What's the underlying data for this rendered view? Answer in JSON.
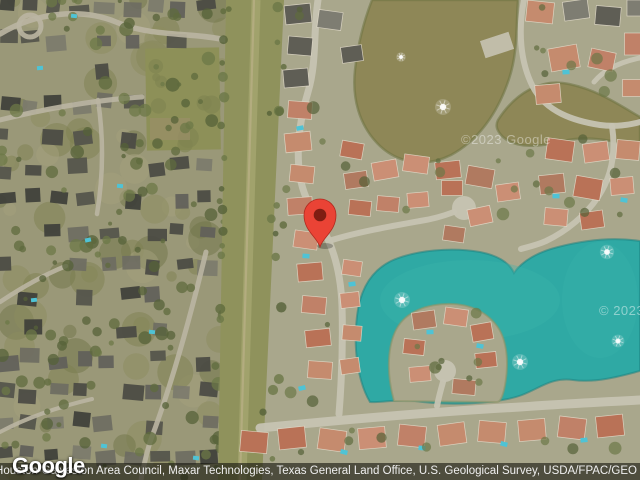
{
  "map": {
    "watermark_center": "©2023 Google",
    "watermark_right_edge": "© 2023"
  },
  "footer": {
    "logo_text": "Google",
    "attribution_text": "ous, Houston-Galveston Area Council, Maxar Technologies, Texas General Land Office, U.S. Geological Survey, USDA/FPAC/GEO"
  },
  "colors": {
    "ground_left": "#9A9878",
    "ground_right": "#A9A78C",
    "easement_green": "#8F925C",
    "field_green": "#8D9058",
    "road_left": "#BAB5A2",
    "road_right": "#C6C3B2",
    "pond_olive": "#8E8757",
    "lake_teal": "#2FA9A4",
    "pool_cyan": "#4FC3D5",
    "roof_terracotta": "#BD7F68",
    "roof_dark": "#55544C",
    "pin_red": "#EA4335",
    "pin_dot": "#7F1D12",
    "attribution_bar": "rgba(22,22,14,0.62)",
    "attribution_text": "#EFEFEF"
  }
}
